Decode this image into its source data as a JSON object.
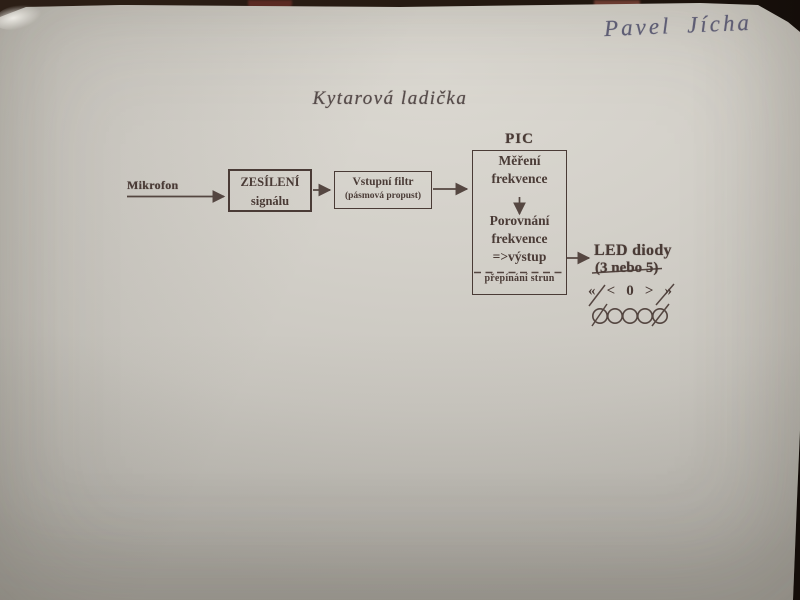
{
  "photo": {
    "handwritten_name": "Pavel Jícha",
    "title": "Kytarová ladička"
  },
  "diagram": {
    "mikrofon": {
      "label": "Mikrofon"
    },
    "amplifier_box": {
      "line1": "ZESÍLENÍ",
      "line2": "signálu"
    },
    "filter_box": {
      "line1": "Vstupní filtr",
      "line2": "(pásmová propust)"
    },
    "pic_box": {
      "label": "PIC",
      "measure_line1": "Měření",
      "measure_line2": "frekvence",
      "compare_line1": "Porovnání",
      "compare_line2": "frekvence",
      "compare_line3": "=>výstup",
      "footer": "přepínání strun"
    },
    "led": {
      "label_line1": "LED diody",
      "label_line2": "(3 nebo 5)",
      "symbols": [
        "«",
        "<",
        "0",
        ">",
        "»"
      ],
      "circle_count": 5
    }
  },
  "colors": {
    "paper": "#d3d0c9",
    "table_background": "#261a12",
    "ink": "#4a3b36",
    "handwriting_ink": "#53526c"
  }
}
